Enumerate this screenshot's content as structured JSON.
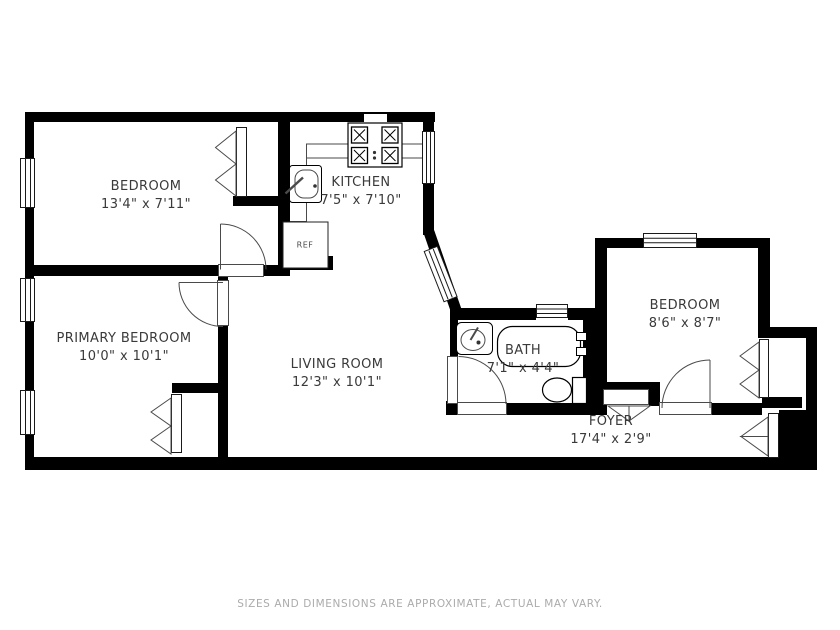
{
  "rooms": {
    "bedroom1": {
      "name": "BEDROOM",
      "dims": "13'4\" x 7'11\""
    },
    "kitchen": {
      "name": "KITCHEN",
      "dims": "7'5\" x 7'10\""
    },
    "primary_bedroom": {
      "name": "PRIMARY BEDROOM",
      "dims": "10'0\" x 10'1\""
    },
    "living_room": {
      "name": "LIVING ROOM",
      "dims": "12'3\" x 10'1\""
    },
    "bath": {
      "name": "BATH",
      "dims": "7'1\" x 4'4\""
    },
    "bedroom2": {
      "name": "BEDROOM",
      "dims": "8'6\" x 8'7\""
    },
    "foyer": {
      "name": "FOYER",
      "dims": "17'4\" x 2'9\""
    }
  },
  "appliances": {
    "refrigerator": "REF"
  },
  "footer": {
    "disclaimer": "SIZES AND DIMENSIONS ARE APPROXIMATE, ACTUAL MAY VARY."
  },
  "colors": {
    "wall": "#000000",
    "thin_line": "#4a4a4a",
    "text": "#3a3a3a",
    "footer_text": "#ababab",
    "background": "#ffffff"
  }
}
